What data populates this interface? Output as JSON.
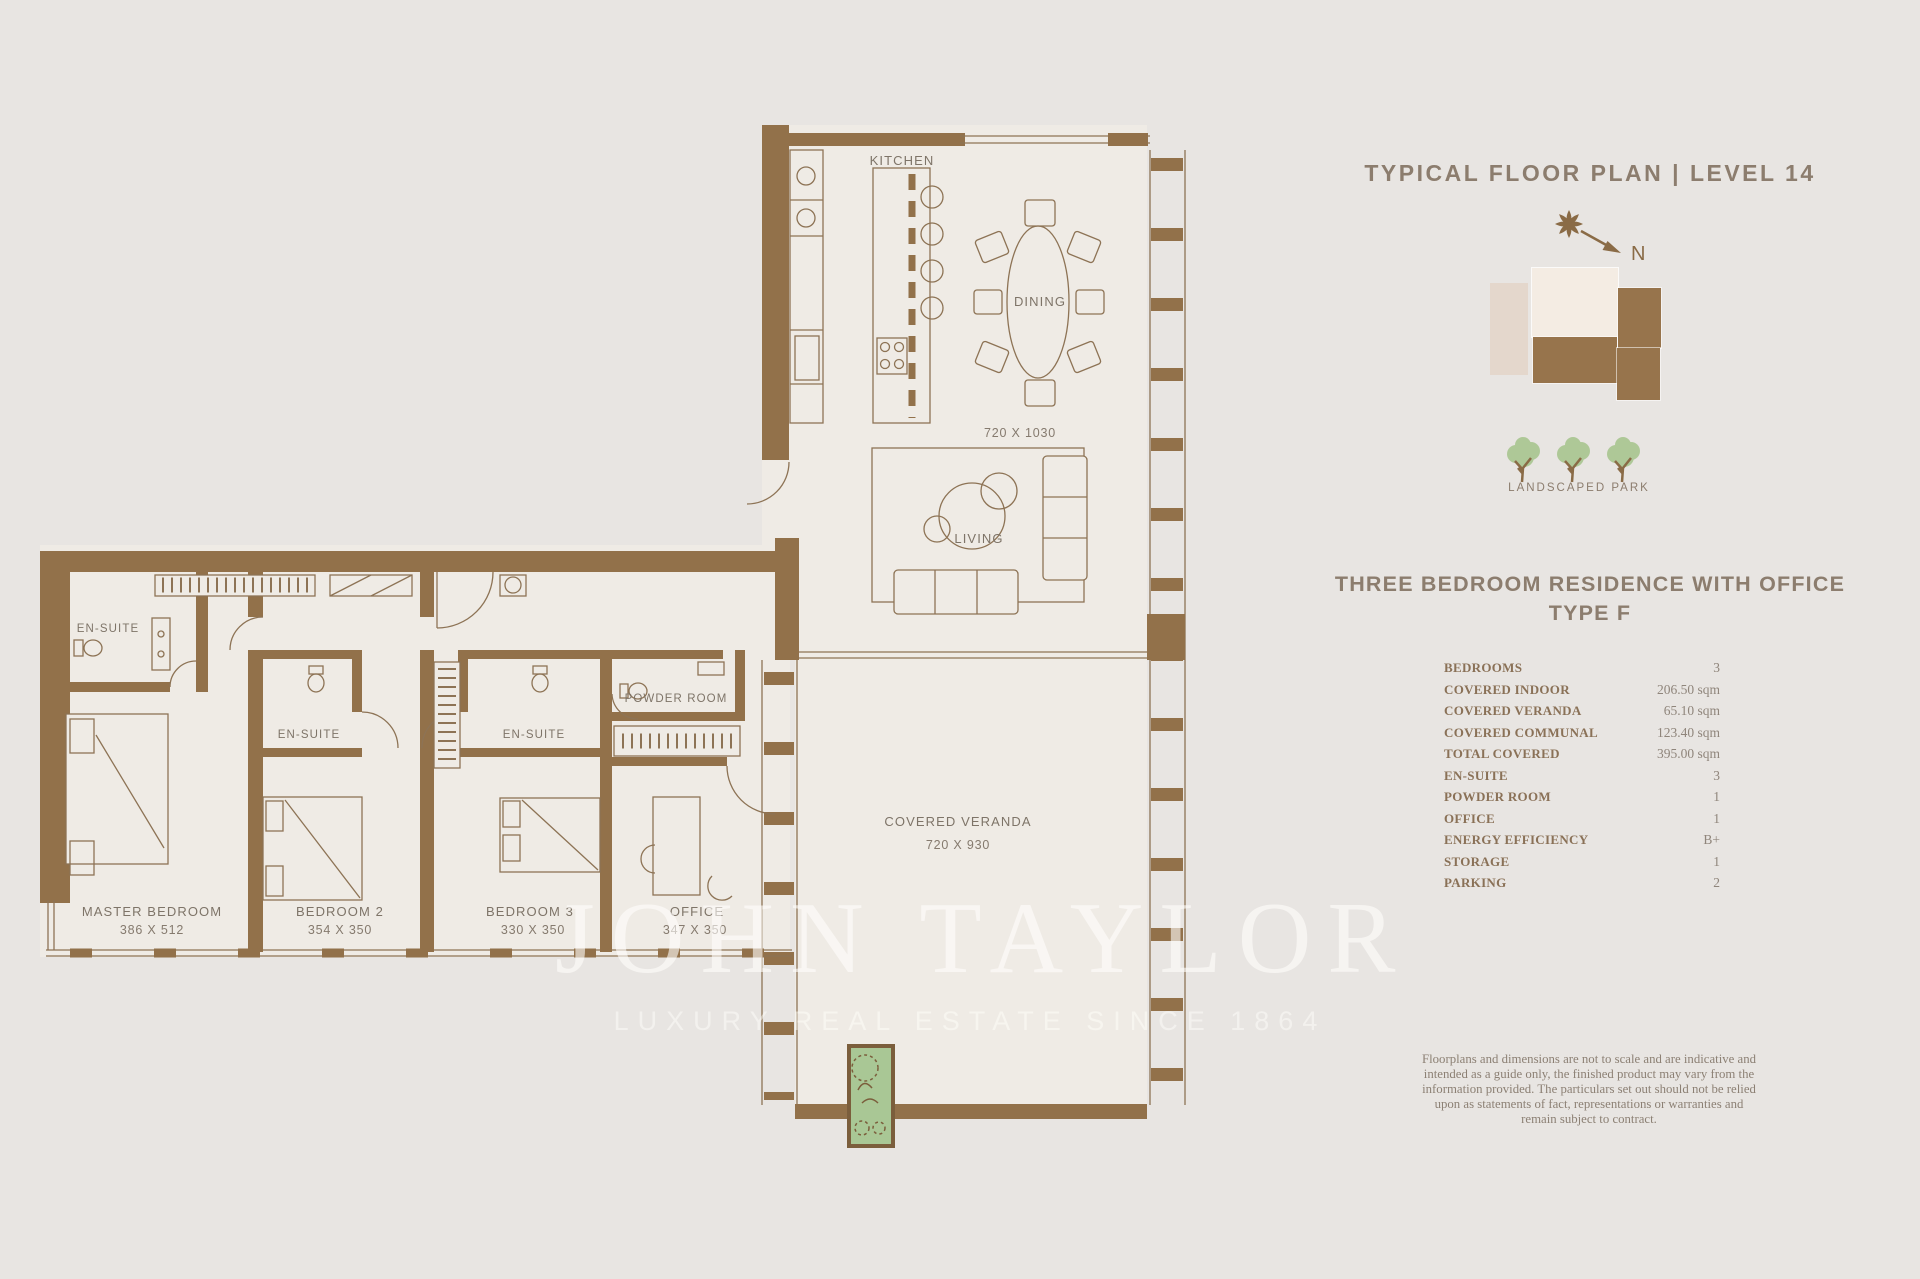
{
  "panel": {
    "title": "TYPICAL FLOOR PLAN | LEVEL 14",
    "compass_label": "N",
    "park_label": "LANDSCAPED PARK",
    "residence_title_line1": "THREE BEDROOM RESIDENCE WITH OFFICE",
    "residence_title_line2": "TYPE F",
    "specs": [
      {
        "label": "BEDROOMS",
        "value": "3"
      },
      {
        "label": "COVERED INDOOR",
        "value": "206.50 sqm"
      },
      {
        "label": "COVERED VERANDA",
        "value": "65.10 sqm"
      },
      {
        "label": "COVERED COMMUNAL",
        "value": "123.40 sqm"
      },
      {
        "label": "TOTAL COVERED",
        "value": "395.00 sqm"
      },
      {
        "label": "EN-SUITE",
        "value": "3"
      },
      {
        "label": "POWDER ROOM",
        "value": "1"
      },
      {
        "label": "OFFICE",
        "value": "1"
      },
      {
        "label": "ENERGY EFFICIENCY",
        "value": "B+"
      },
      {
        "label": "STORAGE",
        "value": "1"
      },
      {
        "label": "PARKING",
        "value": "2"
      }
    ],
    "disclaimer": "Floorplans and dimensions are not to scale and are indicative and intended as a guide only, the finished product may vary from the information provided. The particulars set out should not be relied upon as statements of fact, representations or warranties and remain subject to contract."
  },
  "plan": {
    "rooms": {
      "kitchen": {
        "name": "KITCHEN"
      },
      "dining": {
        "name": "DINING",
        "dims": "720 X 1030"
      },
      "living": {
        "name": "LIVING"
      },
      "veranda": {
        "name": "COVERED VERANDA",
        "dims": "720 X 930"
      },
      "powder": {
        "name": "POWDER ROOM"
      },
      "ensuite_master": {
        "name": "EN-SUITE"
      },
      "ensuite_bedroom2": {
        "name": "EN-SUITE"
      },
      "ensuite_bedroom3": {
        "name": "EN-SUITE"
      },
      "master": {
        "name": "MASTER BEDROOM",
        "dims": "386 X 512"
      },
      "bedroom2": {
        "name": "BEDROOM 2",
        "dims": "354 X 350"
      },
      "bedroom3": {
        "name": "BEDROOM 3",
        "dims": "330 X 350"
      },
      "office": {
        "name": "OFFICE",
        "dims": "347 X 350"
      }
    }
  },
  "watermark": {
    "brand": "JOHN TAYLOR",
    "tagline": "LUXURY REAL ESTATE SINCE 1864"
  },
  "colors": {
    "background": "#e8e5e2",
    "floor": "#efebe5",
    "wall_brown": "#92714a",
    "text_brown": "#8c7d6e",
    "spec_label_brown": "#8a7157",
    "tree_green": "#aec897",
    "planter_green": "#a9c795",
    "watermark_white": "#fffefb"
  }
}
